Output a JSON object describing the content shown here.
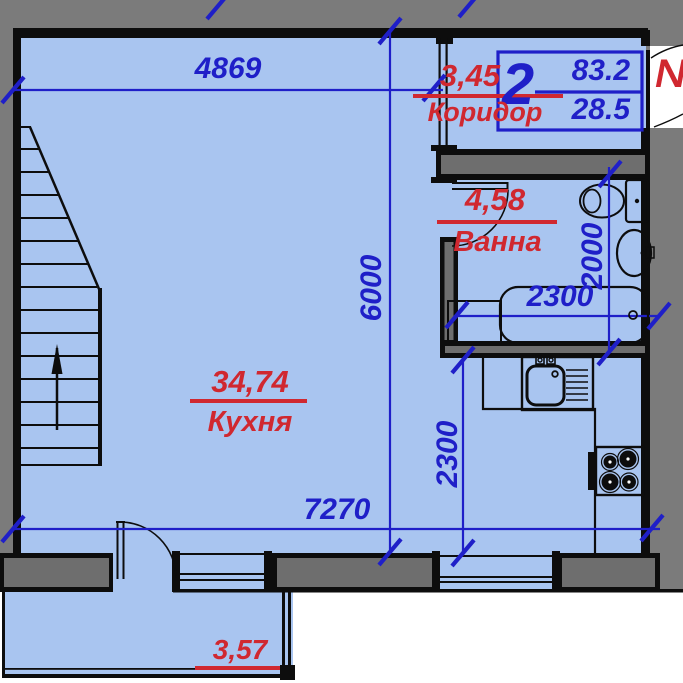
{
  "plan": {
    "apartment_box": {
      "number": "2",
      "total_area": "83.2",
      "living_area": "28.5"
    },
    "entrance_label": "№",
    "rooms": {
      "corridor": {
        "area": "3,45",
        "name": "Коридор"
      },
      "bath": {
        "area": "4,58",
        "name": "Ванна"
      },
      "kitchen": {
        "area": "34,74",
        "name": "Кухня"
      },
      "balcony": {
        "area": "3,57"
      }
    },
    "dimensions": {
      "top_width": "4869",
      "left_height": "6000",
      "bottom_width": "7270",
      "kitchen_recess_depth": "2300",
      "bath_width": "2300",
      "bath_height": "2000"
    },
    "colors": {
      "room_fill": "#a9c5f0",
      "wall_fill": "#6e6e6e",
      "outer_fill": "#7b7b7b",
      "dimension_blue": "#1f1fc8",
      "label_red": "#d02830",
      "line_black": "#0d0d0d"
    }
  }
}
